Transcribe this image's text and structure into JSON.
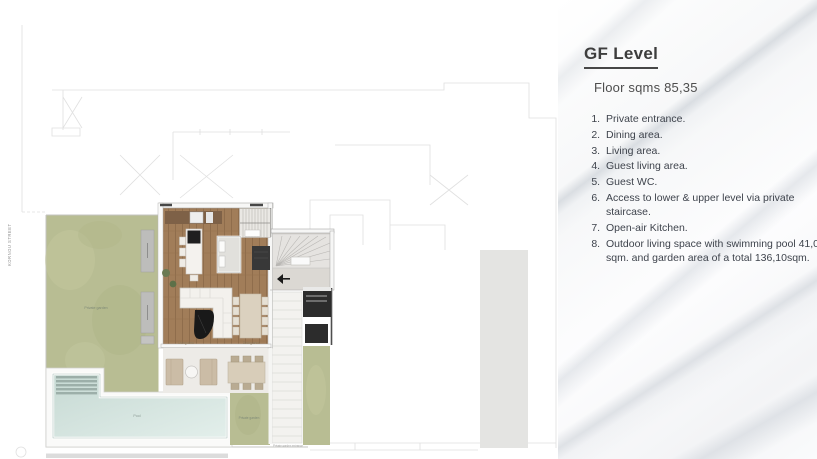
{
  "panel": {
    "title": "GF Level",
    "subtitle": "Floor sqms 85,35",
    "items": [
      "Private entrance.",
      "Dining area.",
      "Living area.",
      "Guest living area.",
      "Guest WC.",
      "Access to lower & upper level via private staircase.",
      "Open-air Kitchen.",
      "Outdoor living space with swimming pool 41,03 sqm. and garden area of a total 136,10sqm."
    ]
  },
  "plan": {
    "street_label": "KORNOU STREET",
    "labels": {
      "garden_left": "Private garden",
      "living": "Living area",
      "dining": "Dining area",
      "pool": "Pool",
      "garden_right": "Private garden",
      "walkway": "Private garden entrance"
    },
    "colors": {
      "garden_green": "#b8bd93",
      "pool_water": "#cfe0da",
      "wood_floor": "#a07c58",
      "dark_furniture": "#2c2c2c",
      "terrace": "#edebe7",
      "panel_text": "#3e434c",
      "marble_vein": "#c5ccd4"
    }
  }
}
